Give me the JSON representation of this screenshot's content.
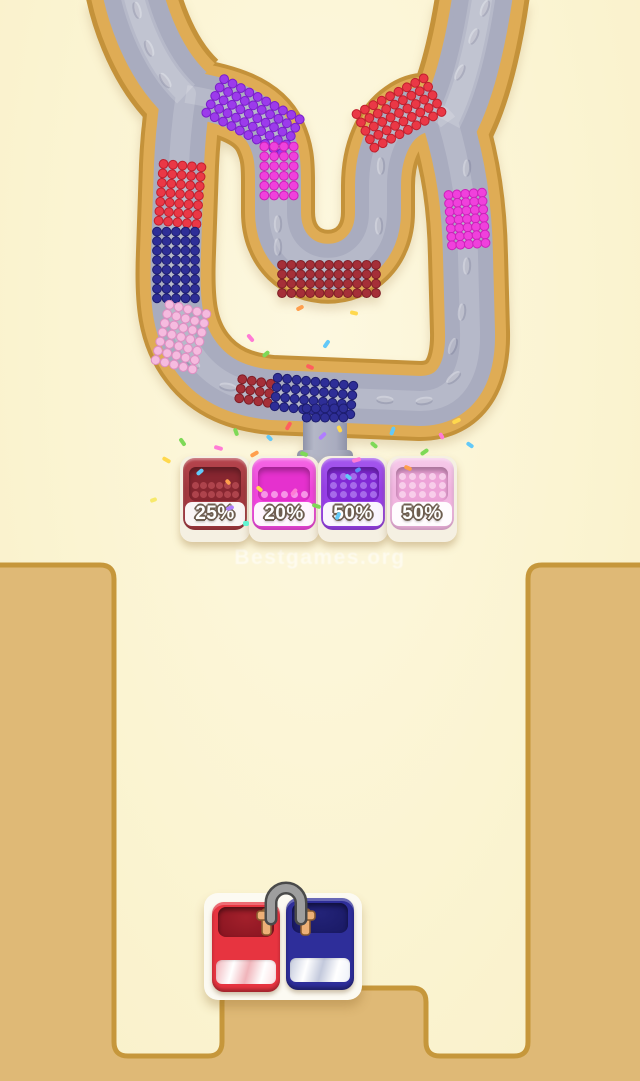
{
  "background": "#FBF4D2",
  "watermark": {
    "text": "Bestgames.org"
  },
  "tube": {
    "colors": {
      "outline": "#C4923A",
      "tan": "#DFAC55",
      "gray": "#A9ACBF",
      "highlight": "rgba(255,255,255,0.16)"
    },
    "segments": [
      {
        "name": "purple-corner-top-left",
        "color": "#9C3BEB",
        "dark": "#7A1FC9",
        "cx": 253,
        "cy": 116,
        "rot": 28,
        "cols": 10,
        "rows": 5,
        "sp": 9.5
      },
      {
        "name": "magenta-center-left",
        "color": "#F041DC",
        "dark": "#CC21BA",
        "cx": 279,
        "cy": 171,
        "rot": 0,
        "cols": 4,
        "rows": 6,
        "sp": 9.8
      },
      {
        "name": "maroon-inner-u-bottom",
        "color": "#A52F38",
        "dark": "#7F1F27",
        "cx": 329,
        "cy": 279,
        "rot": 0,
        "cols": 11,
        "rows": 4,
        "sp": 9.4
      },
      {
        "name": "red-corner-top-right",
        "color": "#EA3846",
        "dark": "#C01F2D",
        "cx": 399,
        "cy": 113,
        "rot": -28,
        "cols": 9,
        "rows": 5,
        "sp": 9.5
      },
      {
        "name": "red-left-side",
        "color": "#EA3846",
        "dark": "#C01F2D",
        "cx": 180,
        "cy": 194,
        "rot": 5,
        "cols": 5,
        "rows": 7,
        "sp": 9.5
      },
      {
        "name": "navy-left-side",
        "color": "#2E2E97",
        "dark": "#1D1D6F",
        "cx": 176,
        "cy": 265,
        "rot": 0,
        "cols": 5,
        "rows": 8,
        "sp": 9.5
      },
      {
        "name": "pink-left-curve",
        "color": "#F5BBDF",
        "dark": "#DE8FC2",
        "cx": 181,
        "cy": 337,
        "rot": 14,
        "cols": 5,
        "rows": 7,
        "sp": 9.5
      },
      {
        "name": "maroon-bottom-channel",
        "color": "#A52F38",
        "dark": "#7F1F27",
        "cx": 255,
        "cy": 391,
        "rot": 9,
        "cols": 4,
        "rows": 3,
        "sp": 9.6
      },
      {
        "name": "navy-bottom-channel",
        "color": "#2E2E97",
        "dark": "#1D1D6F",
        "cx": 314,
        "cy": 396,
        "rot": 6,
        "cols": 9,
        "rows": 4,
        "sp": 9.5
      },
      {
        "name": "navy-funnel-into-pipe",
        "color": "#2E2E97",
        "dark": "#1D1D6F",
        "cx": 325,
        "cy": 413,
        "rot": 0,
        "cols": 5,
        "rows": 2,
        "sp": 9.2
      },
      {
        "name": "magenta-right-side",
        "color": "#F041DC",
        "dark": "#CC21BA",
        "cx": 467,
        "cy": 219,
        "rot": -4,
        "cols": 5,
        "rows": 7,
        "sp": 8.4
      }
    ],
    "bumps": [
      [
        138,
        10,
        75
      ],
      [
        150,
        48,
        68
      ],
      [
        166,
        80,
        55
      ],
      [
        193,
        362,
        35
      ],
      [
        228,
        386,
        10
      ],
      [
        385,
        399,
        4
      ],
      [
        424,
        400,
        -8
      ],
      [
        453,
        377,
        -40
      ],
      [
        466,
        168,
        -86
      ],
      [
        466,
        266,
        -88
      ],
      [
        461,
        312,
        -84
      ],
      [
        452,
        346,
        -70
      ],
      [
        459,
        72,
        -62
      ],
      [
        473,
        36,
        -64
      ],
      [
        484,
        8,
        -68
      ],
      [
        380,
        166,
        -90
      ],
      [
        378,
        226,
        -90
      ],
      [
        277,
        224,
        -90
      ],
      [
        277,
        247,
        -90
      ]
    ]
  },
  "field": {
    "fill": "#DFB976",
    "stroke": "#C6973B"
  },
  "bins": [
    {
      "label": "25%",
      "rim": "#B7454E",
      "body": "#A23840",
      "inner": "#872630",
      "dots": {
        "rows": 2,
        "cols": 6,
        "color": "#B34750"
      }
    },
    {
      "label": "20%",
      "rim": "#F468E4",
      "body": "#EF46DC",
      "inner": "#E531CE",
      "dots": {
        "rows": 1,
        "cols": 5,
        "color": "#F8A0EA"
      }
    },
    {
      "label": "50%",
      "rim": "#A559EE",
      "body": "#9740E6",
      "inner": "#8129D5",
      "dots": {
        "rows": 3,
        "cols": 5,
        "color": "#AB71EC"
      }
    },
    {
      "label": "50%",
      "rim": "#F6CBEA",
      "body": "#F1B5E0",
      "inner": "#EDA3D8",
      "dots": {
        "rows": 3,
        "cols": 5,
        "color": "#F8D2EC"
      }
    }
  ],
  "blocks": {
    "left": {
      "face": "#E73440",
      "cavA": "#A3202B",
      "cavB": "#871420",
      "stripeA": "#FBDCDF",
      "stripeB": "#F0B4BA"
    },
    "right": {
      "face": "#2E2E9A",
      "cavA": "#232378",
      "cavB": "#191964",
      "stripeA": "#EDF0F8",
      "stripeB": "#C3C9DC"
    },
    "pin": {
      "metal": "#9E9E9E",
      "metal_dark": "#4A4A4A",
      "bracket": "#EDB077",
      "bracket_dark": "#8A5A2E"
    }
  },
  "confetti": [
    [
      162,
      458,
      "#FFD84D",
      30,
      9,
      4
    ],
    [
      150,
      498,
      "#F7E96B",
      -20,
      7,
      4
    ],
    [
      178,
      440,
      "#7ED957",
      55,
      9,
      4
    ],
    [
      196,
      470,
      "#63C9F8",
      -40,
      8,
      4
    ],
    [
      214,
      446,
      "#FF7BD5",
      15,
      9,
      4
    ],
    [
      232,
      430,
      "#7ED957",
      70,
      8,
      4
    ],
    [
      250,
      452,
      "#FF9F4D",
      -30,
      9,
      4
    ],
    [
      266,
      436,
      "#63C9F8",
      45,
      7,
      4
    ],
    [
      284,
      424,
      "#FF5E5E",
      -60,
      9,
      4
    ],
    [
      300,
      452,
      "#7ED957",
      20,
      8,
      4
    ],
    [
      318,
      434,
      "#B07CFF",
      -45,
      9,
      4
    ],
    [
      336,
      427,
      "#FFD84D",
      65,
      7,
      4
    ],
    [
      352,
      458,
      "#FF7BD5",
      -15,
      9,
      4
    ],
    [
      370,
      443,
      "#7ED957",
      40,
      8,
      4
    ],
    [
      388,
      429,
      "#63C9F8",
      -70,
      9,
      4
    ],
    [
      404,
      466,
      "#FF9F4D",
      25,
      8,
      4
    ],
    [
      420,
      450,
      "#7ED957",
      -35,
      9,
      4
    ],
    [
      438,
      434,
      "#FF7BD5",
      60,
      7,
      4
    ],
    [
      452,
      419,
      "#FFD84D",
      -25,
      9,
      4
    ],
    [
      466,
      443,
      "#63C9F8",
      35,
      8,
      4
    ],
    [
      290,
      490,
      "#FF7BD5",
      -50,
      8,
      4
    ],
    [
      312,
      504,
      "#7ED957",
      18,
      9,
      4
    ],
    [
      334,
      514,
      "#63C9F8",
      -65,
      8,
      4
    ],
    [
      256,
      487,
      "#FFD84D",
      42,
      7,
      4
    ],
    [
      226,
      506,
      "#B07CFF",
      -18,
      8,
      4
    ],
    [
      246,
      336,
      "#FF7BD5",
      50,
      9,
      4
    ],
    [
      262,
      352,
      "#7ED957",
      -40,
      8,
      4
    ],
    [
      306,
      365,
      "#FF5E5E",
      22,
      8,
      4
    ],
    [
      322,
      342,
      "#63C9F8",
      -55,
      9,
      4
    ],
    [
      350,
      311,
      "#FFD84D",
      12,
      8,
      4
    ],
    [
      296,
      306,
      "#FF9F4D",
      -28,
      8,
      4
    ],
    [
      243,
      521,
      "#63F5D2",
      0,
      6,
      5
    ],
    [
      345,
      475,
      "#63C9F8",
      40,
      7,
      4
    ],
    [
      355,
      468,
      "#5B8DF8",
      -30,
      6,
      4
    ],
    [
      225,
      480,
      "#FF9F4D",
      50,
      6,
      4
    ]
  ]
}
